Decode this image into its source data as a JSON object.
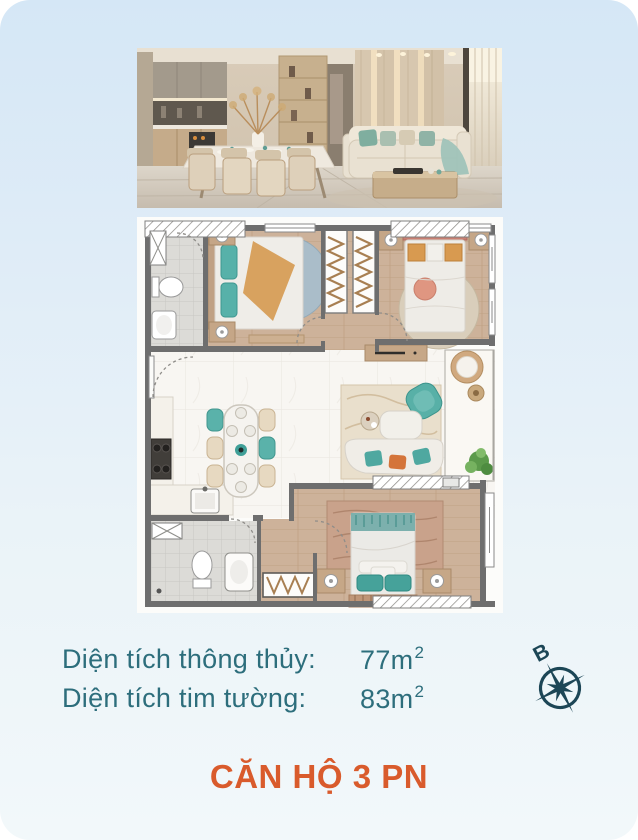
{
  "card": {
    "bg_top": "#d5e7f6",
    "bg_bottom": "#f2f8fa"
  },
  "hero_photo": {
    "name": "interior-render-kitchen-dining-living"
  },
  "floor_plan": {
    "name": "3-bedroom-apartment-floor-plan"
  },
  "specs": {
    "rows": [
      {
        "label": "Diện tích thông thủy:",
        "value": "77m",
        "sup": "2"
      },
      {
        "label": "Diện tích tim tường:",
        "value": "83m",
        "sup": "2"
      }
    ],
    "text_color": "#2d6e7c"
  },
  "compass": {
    "north_label": "B",
    "color": "#1c4656"
  },
  "title": {
    "text": "CĂN HỘ 3 PN",
    "color": "#d95b2c"
  }
}
